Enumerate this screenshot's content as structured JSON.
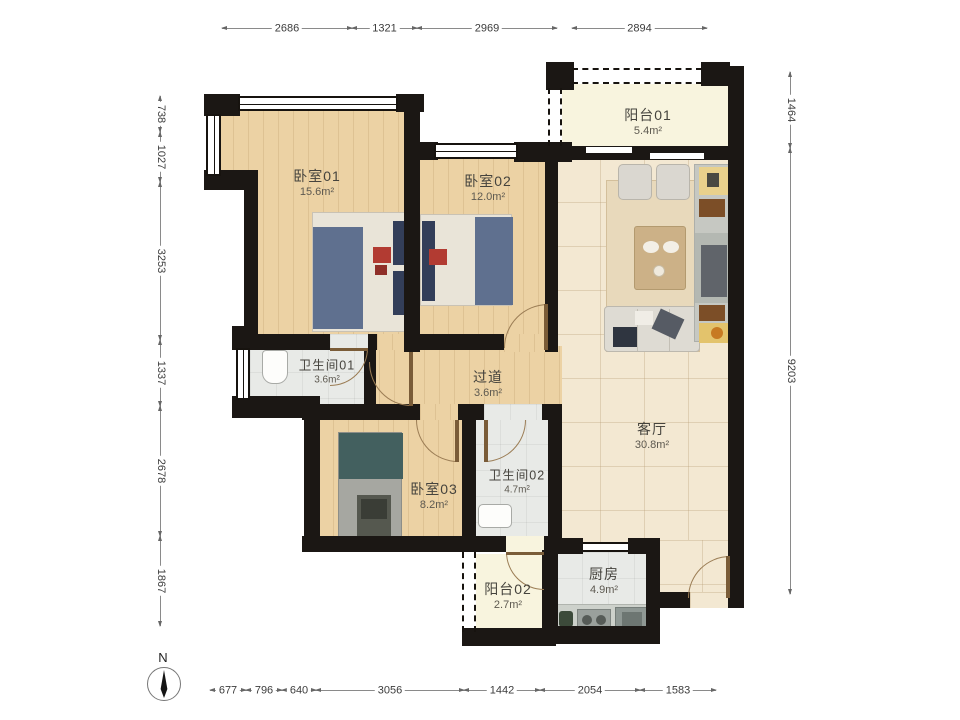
{
  "rooms": [
    {
      "name": "卧室01",
      "area": "15.6m²"
    },
    {
      "name": "卧室02",
      "area": "12.0m²"
    },
    {
      "name": "阳台01",
      "area": "5.4m²"
    },
    {
      "name": "卫生间01",
      "area": "3.6m²"
    },
    {
      "name": "过道",
      "area": "3.6m²"
    },
    {
      "name": "客厅",
      "area": "30.8m²"
    },
    {
      "name": "卧室03",
      "area": "8.2m²"
    },
    {
      "name": "卫生间02",
      "area": "4.7m²"
    },
    {
      "name": "阳台02",
      "area": "2.7m²"
    },
    {
      "name": "厨房",
      "area": "4.9m²"
    }
  ],
  "dimensions": {
    "top": [
      "2686",
      "1321",
      "2969",
      "2894"
    ],
    "left": [
      "738",
      "1027",
      "3253",
      "1337",
      "2678",
      "1867"
    ],
    "right": [
      "1464",
      "9203"
    ],
    "bottom": [
      "677",
      "796",
      "640",
      "3056",
      "1442",
      "2054",
      "1583"
    ]
  },
  "compass": {
    "north_label": "N"
  },
  "colors": {
    "wall": "#1b1714",
    "wood_floor": "#ecd2a4",
    "tile_floor": "#f3e8d2",
    "wet_floor": "#e8eae7",
    "balcony_floor": "#f8f4de"
  }
}
